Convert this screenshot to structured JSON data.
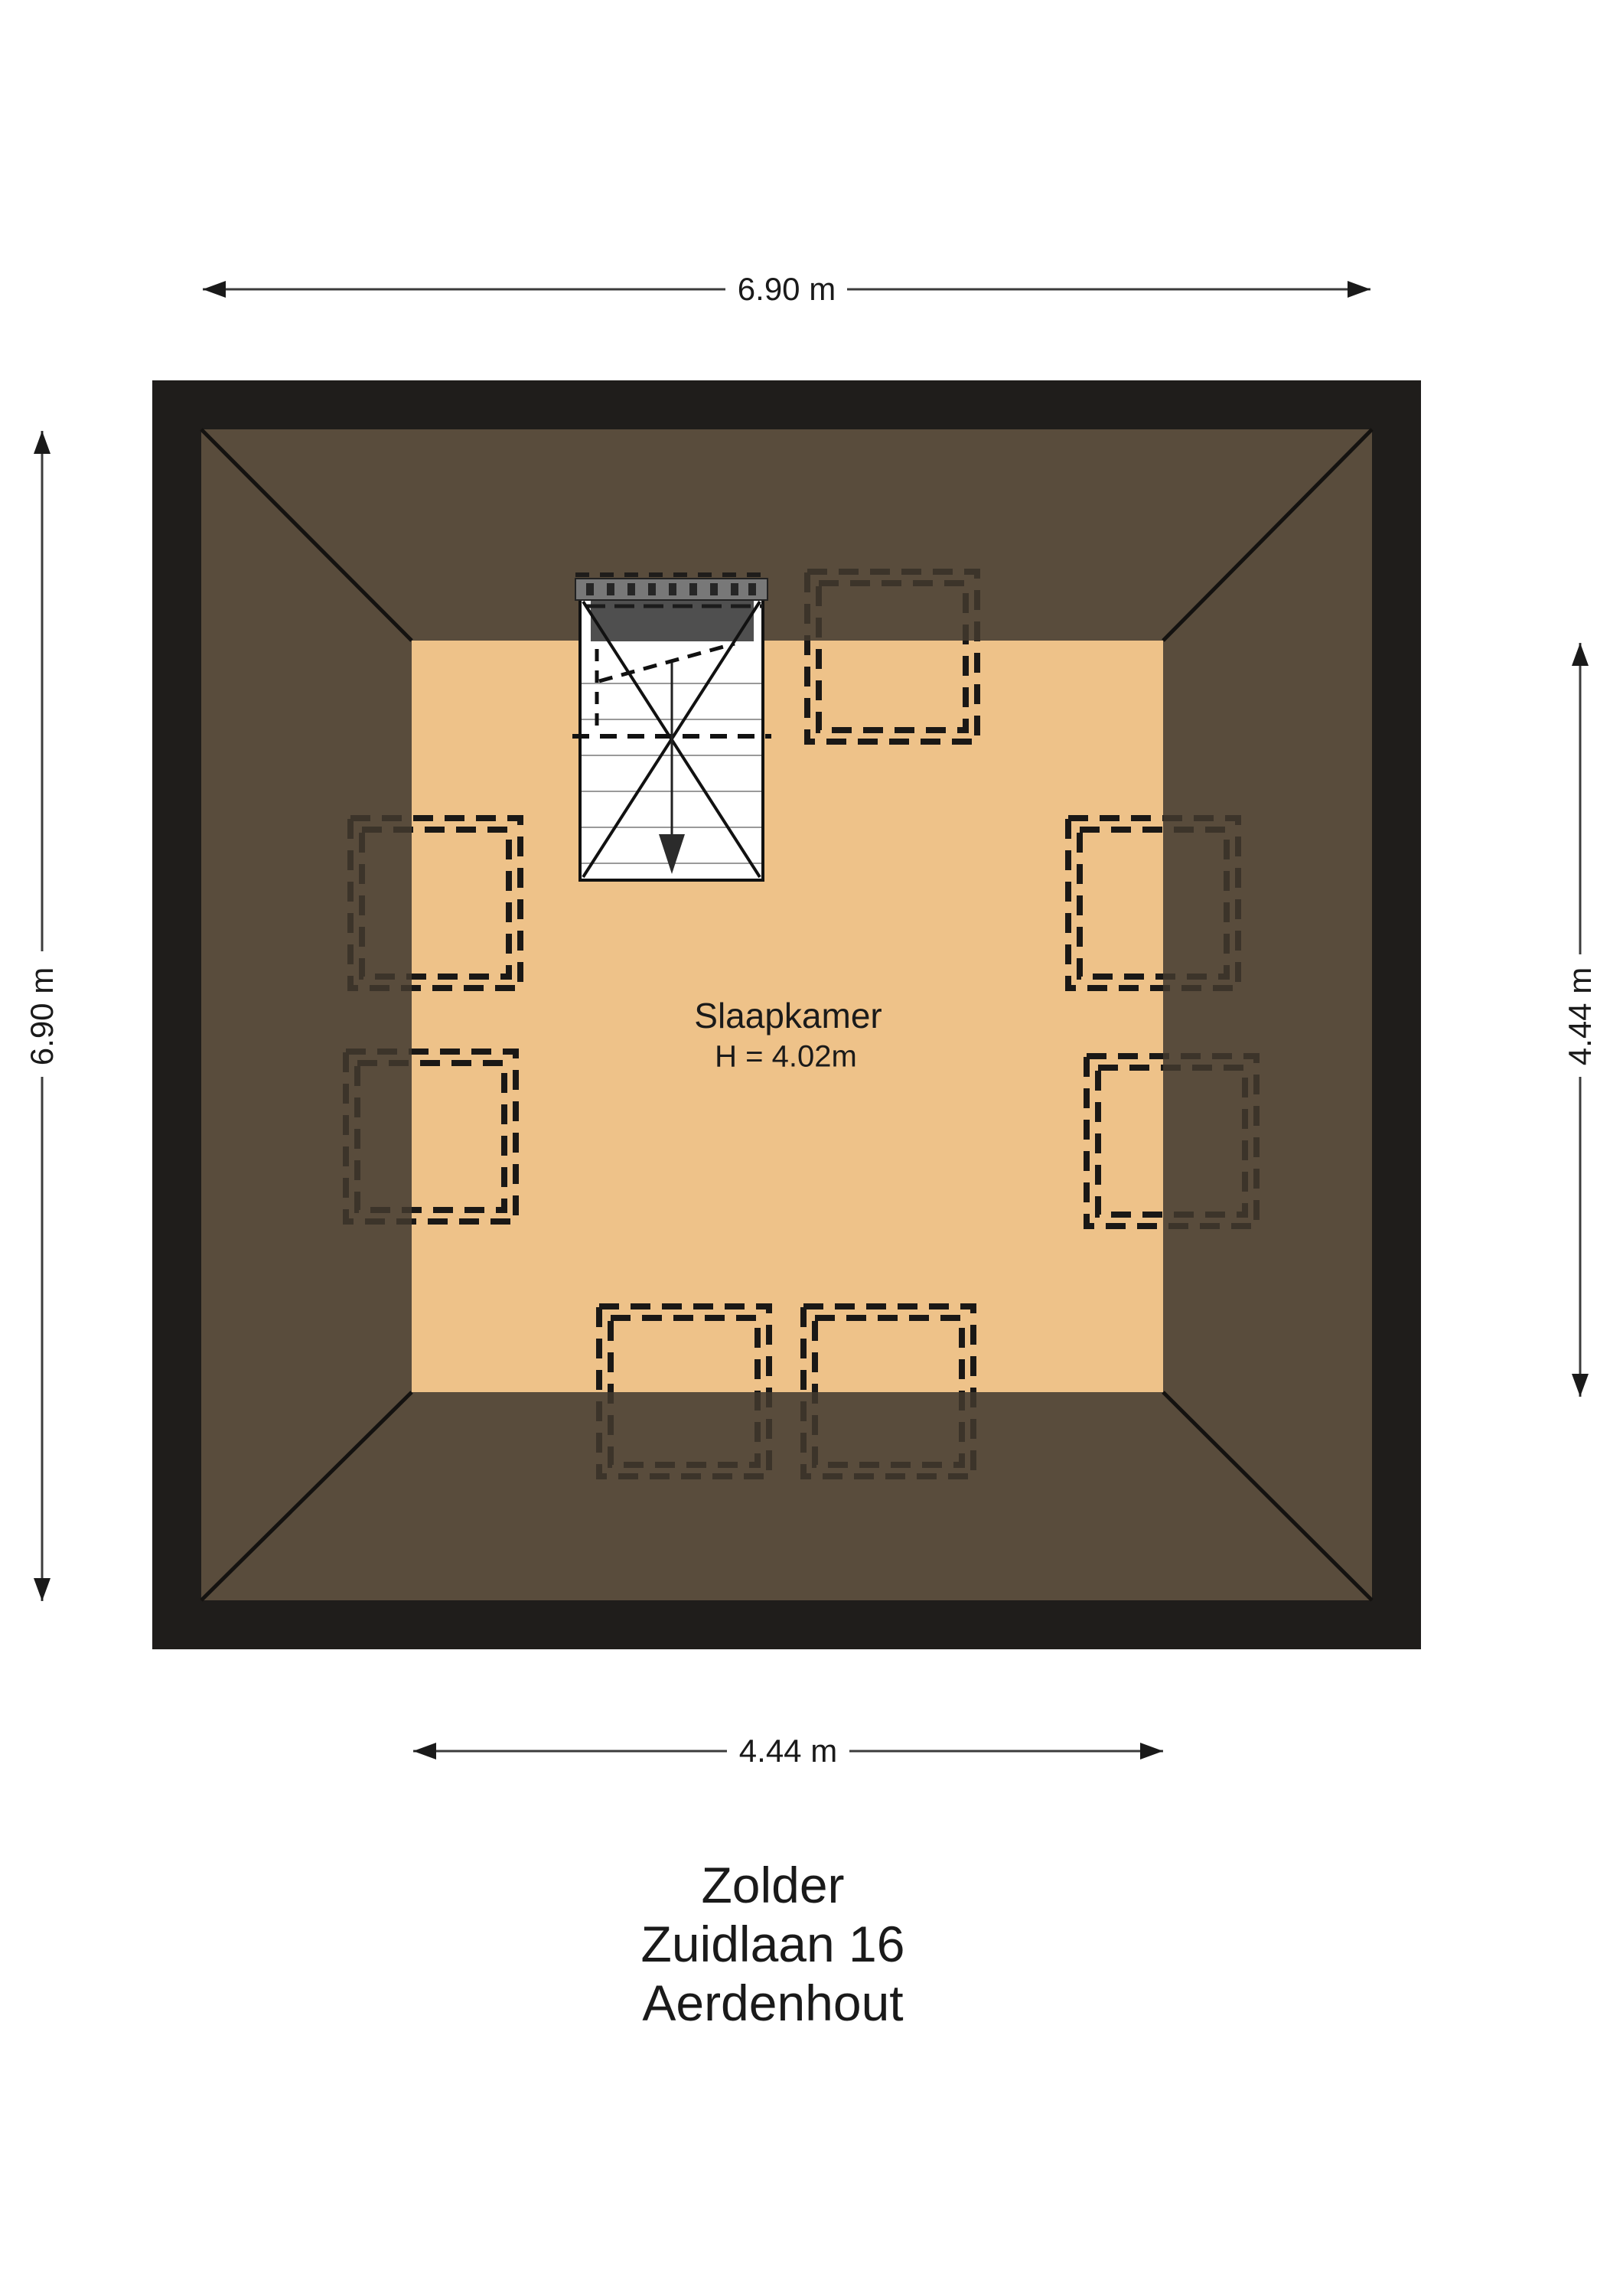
{
  "room": {
    "name": "Slaapkamer",
    "height": "H = 4.02m"
  },
  "dimensions": {
    "top": "6.90 m",
    "left": "6.90 m",
    "right": "4.44 m",
    "bottom": "4.44 m"
  },
  "title": {
    "line1": "Zolder",
    "line2": "Zuidlaan 16",
    "line3": "Aerdenhout"
  },
  "icons": {
    "stair_direction": "down-arrow"
  },
  "colors": {
    "wall": "#1f1d1b",
    "roof": "#5a4c3c",
    "floor": "#eec289",
    "dash": "#1a1816",
    "page": "#ffffff"
  }
}
